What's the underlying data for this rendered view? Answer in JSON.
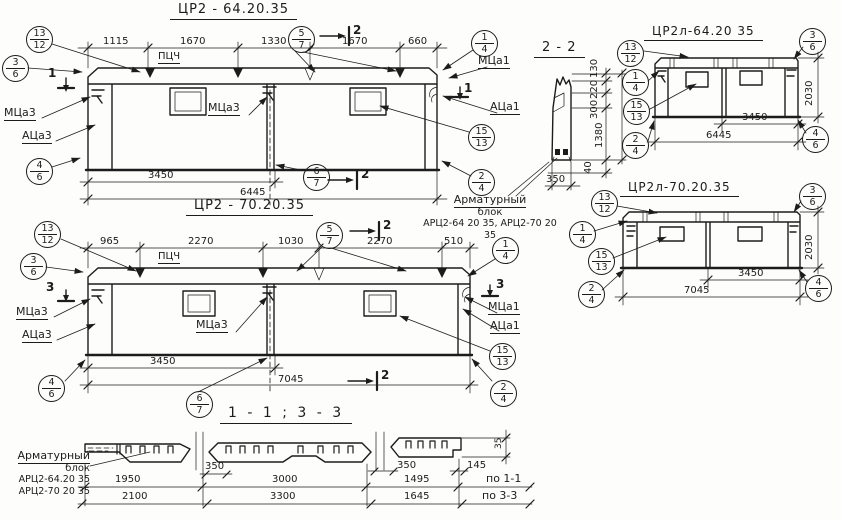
{
  "titles": {
    "panel1": "ЦР2 - 64.20.35",
    "panel2": "ЦР2 - 70.20.35",
    "section22": "2 - 2",
    "right1": "ЦР2л-64.20 35",
    "right2": "ЦР2л-70.20.35",
    "bottom": "1 - 1  ;  3 - 3"
  },
  "labels": {
    "pcch": "ПЦЧ",
    "mca3": "МЦа3",
    "aca3": "АЦа3",
    "mca1": "МЦа1",
    "aca1": "АЦа1"
  },
  "cuts": {
    "one": "1",
    "two": "2",
    "three": "3"
  },
  "balloons": {
    "b13_12": {
      "top": "13",
      "bottom": "12"
    },
    "b3_6": {
      "top": "3",
      "bottom": "6"
    },
    "b5_7": {
      "top": "5",
      "bottom": "7"
    },
    "b1_4": {
      "top": "1",
      "bottom": "4"
    },
    "b15_13": {
      "top": "15",
      "bottom": "13"
    },
    "b4_6": {
      "top": "4",
      "bottom": "6"
    },
    "b6_7": {
      "top": "6",
      "bottom": "7"
    },
    "b2_4": {
      "top": "2",
      "bottom": "4"
    }
  },
  "panel1": {
    "dims_top": [
      "1115",
      "1670",
      "1330",
      "1670",
      "660"
    ],
    "dim_3450": "3450",
    "dim_total": "6445"
  },
  "panel2": {
    "dims_top": [
      "965",
      "2270",
      "1030",
      "2270",
      "510"
    ],
    "dim_3450": "3450",
    "dim_total": "7045"
  },
  "section22": {
    "dims_v": [
      "130",
      "220",
      "300",
      "1380",
      "40"
    ],
    "dim_w": "350"
  },
  "right1": {
    "dim_a": "3450",
    "dim_b": "6445",
    "dim_h": "2030"
  },
  "right2": {
    "dim_a": "3450",
    "dim_b": "7045",
    "dim_h": "2030"
  },
  "note_center": {
    "line1": "Арматурный",
    "line2": "блок",
    "line3": "АРЦ2-64 20 35, АРЦ2-70 20 35"
  },
  "note_left": {
    "line1": "Арматурный",
    "line2": "блок",
    "line3": "АРЦ2-64.20 35",
    "line4": "АРЦ2-70 20 35"
  },
  "bottom": {
    "dim_gap1": "350",
    "dim_gap2": "350",
    "dim_145": "145",
    "dim_35": "35",
    "row1": {
      "c1": "1950",
      "c2": "3000",
      "c3": "1495",
      "label": "по 1-1"
    },
    "row2": {
      "c1": "2100",
      "c2": "3300",
      "c3": "1645",
      "label": "по 3-3"
    }
  }
}
